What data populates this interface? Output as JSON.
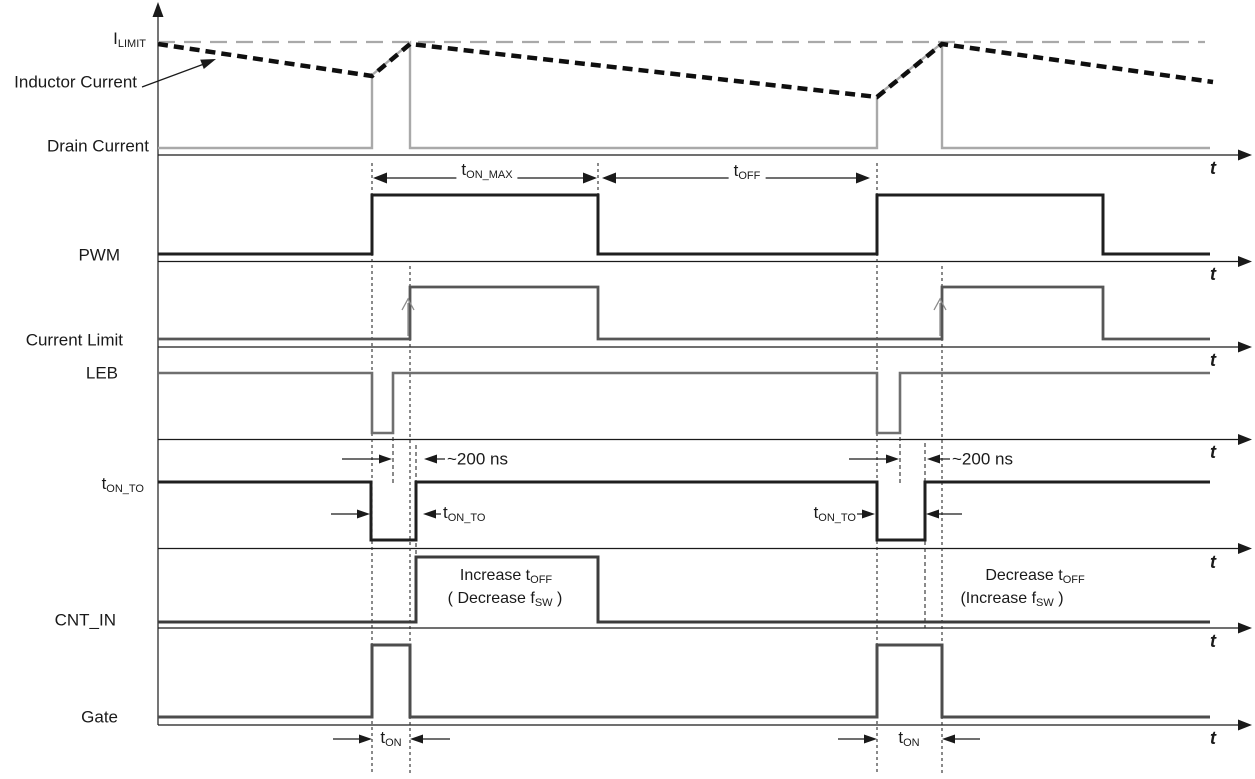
{
  "diagram": {
    "axis_label": "t",
    "row_labels": {
      "i_limit_base": "I",
      "i_limit_sub": "LIMIT",
      "inductor_current": "Inductor Current",
      "drain_current": "Drain Current",
      "pwm": "PWM",
      "current_limit": "Current Limit",
      "leb": "LEB",
      "t_on_to_base": "t",
      "t_on_to_sub": "ON_TO",
      "cnt_in": "CNT_IN",
      "gate": "Gate"
    },
    "annotations": {
      "t_on_max_base": "t",
      "t_on_max_sub": "ON_MAX",
      "t_off_base": "t",
      "t_off_sub": "OFF",
      "blanking_delay": "~200 ns",
      "t_on_to_base": "t",
      "t_on_to_sub": "ON_TO",
      "t_on_base": "t",
      "t_on_sub": "ON",
      "increase_line1_base": "Increase t",
      "increase_line1_sub": "OFF",
      "increase_line2_base": "( Decrease f",
      "increase_line2_sub": "SW",
      "increase_line2_tail": " )",
      "decrease_line1_base": "Decrease t",
      "decrease_line1_sub": "OFF",
      "decrease_line2_base": "(Increase f",
      "decrease_line2_sub": "SW",
      "decrease_line2_tail": " )"
    },
    "colors": {
      "text": "#1a1a1a",
      "axis": "#1a1a1a",
      "inductor_current": "#0f0f0f",
      "drain_current": "#a9a9a9",
      "i_limit_line": "#a9a9a9",
      "pwm": "#1f1f1f",
      "current_limit": "#565656",
      "leb": "#6f6f6f",
      "t_on_to": "#1f1f1f",
      "cnt_in": "#3c3c3c",
      "gate": "#4d4d4d",
      "reference_line": "#2b2b2b",
      "limit_arrow": "#8a8a8a"
    }
  }
}
